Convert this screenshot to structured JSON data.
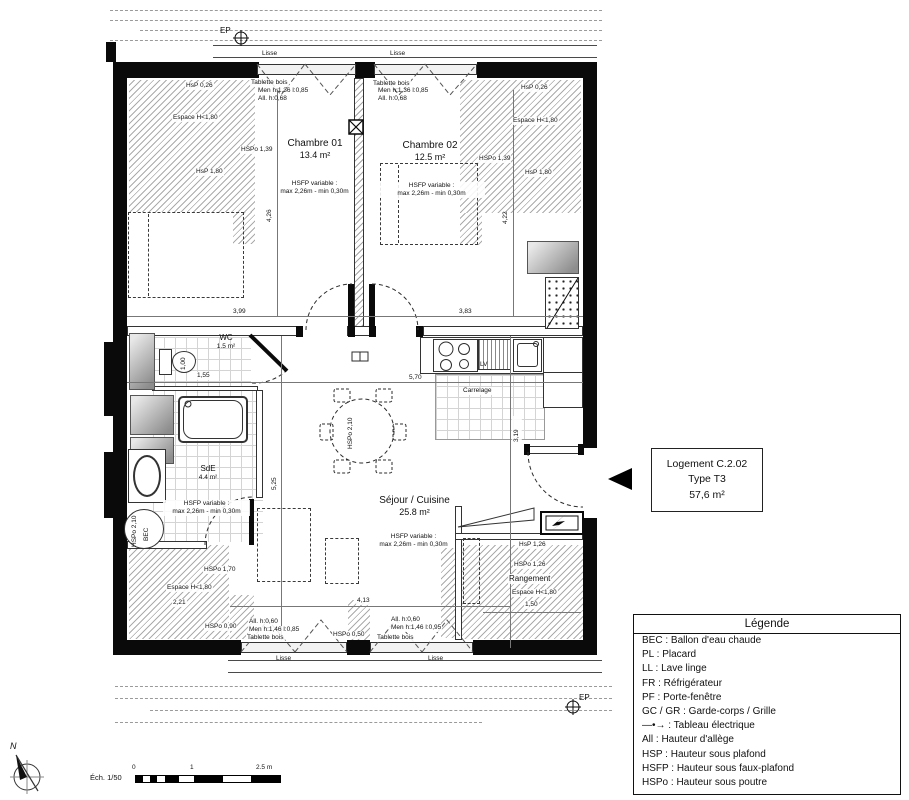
{
  "info_box": {
    "line1": "Logement C.2.02",
    "line2": "Type T3",
    "line3": "57,6 m²"
  },
  "legend": {
    "title": "Légende",
    "items": [
      "BEC : Ballon d'eau chaude",
      "PL : Placard",
      "LL : Lave linge",
      "FR : Réfrigérateur",
      "PF : Porte-fenêtre",
      "GC / GR : Garde-corps / Grille",
      "—•→ : Tableau électrique",
      "All : Hauteur d'allège",
      "HSP : Hauteur sous plafond",
      "HSFP : Hauteur sous faux-plafond",
      "HSPo : Hauteur sous poutre"
    ]
  },
  "rooms": {
    "chambre1": {
      "name": "Chambre 01",
      "area": "13.4 m²"
    },
    "chambre2": {
      "name": "Chambre 02",
      "area": "12.5 m²"
    },
    "wc": {
      "name": "WC",
      "area": "1.5 m²"
    },
    "sde": {
      "name": "SdE",
      "area": "4.4 m²"
    },
    "sejour": {
      "name": "Séjour / Cuisine",
      "area": "25.8 m²"
    },
    "rangement": {
      "name": "Rangement"
    }
  },
  "hsfp_note": {
    "l1": "HSFP variable :",
    "l2": "max 2,26m - min 0,30m"
  },
  "labels": {
    "espace": "Espace H<1,80",
    "hsp026": "HsP 0,26",
    "hspo139": "HSPo 1,39",
    "hsp180": "HsP 1,80",
    "hspo170": "HSPo 1,70",
    "hspo090": "HSPo 0,90",
    "hsp126": "HsP 1,26",
    "hspo126": "HSPo 1,26",
    "hspo050": "HSPo 0,50",
    "hspo210": "HSPo 2,10",
    "bec": "BEC",
    "tablette": "Tablette bois",
    "lisse": "Lisse",
    "ep": "EP",
    "carrelage": "Carrelage",
    "lv": "LV",
    "men_top": "Men h:1,36 l:0,85",
    "all_top": "All. h:0,68",
    "all_bot": "All. h:0,60",
    "men_bot_l": "Men h:1,46 l:0,85",
    "men_bot_r": "Men h:1,46 l:0,95"
  },
  "dims": {
    "d399": "3,99",
    "d383": "3,83",
    "d426": "4,26",
    "d422": "4,22",
    "d570": "5,70",
    "d525": "5,25",
    "d319": "3,19",
    "d413": "4,13",
    "d155": "1,55",
    "d100": "1,00",
    "d150": "1,50",
    "d221": "2,21"
  },
  "footer": {
    "scale_label": "Éch. 1/50",
    "tick0": "0",
    "tick1": "1",
    "tick25": "2.5 m",
    "north": "N"
  }
}
